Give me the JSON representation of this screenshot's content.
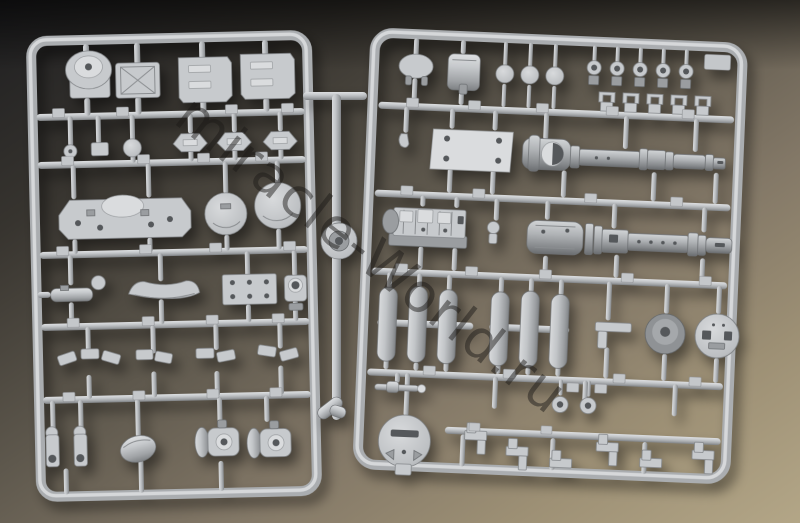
{
  "scene": {
    "type": "photograph",
    "description": "Two light-gray injection-molded plastic model-kit sprues (runner frames full of tank model parts) lying on a dark desk, lit warmly from the lower right",
    "subject": "scale model kit sprues"
  },
  "watermark": {
    "text": "miracle-World.ru"
  },
  "colors": {
    "background_dark": "#202022",
    "background_tan": "#b2a485",
    "plastic": "#c7cacd",
    "plastic_shadow": "#84878a",
    "plastic_dark": "#9a9da0",
    "hole": "#55585b"
  },
  "sprues": {
    "left": {
      "name": "left sprue frame",
      "parts": [
        "commander cupola",
        "hatch with X brace",
        "stowage box",
        "stowage box",
        "small cap",
        "small block",
        "ball mount",
        "hex hatch",
        "hex hatch",
        "hex hatch",
        "hull deck piece",
        "wheel disc",
        "wheel disc",
        "exhaust muffler",
        "curved fender",
        "bolted plate",
        "cylinder mount",
        "mounting brackets (4 sets)",
        "towing shackle",
        "towing shackle",
        "oval drum",
        "final drive housing",
        "final drive housing"
      ]
    },
    "center": {
      "name": "loose center runner",
      "parts": [
        "runner rod",
        "round wheel blank",
        "angled elbow joint"
      ]
    },
    "right": {
      "name": "right sprue frame",
      "parts": [
        "vision port",
        "cylinder drum",
        "wheel cap",
        "wheel cap",
        "wheel cap",
        "towing eye (x5)",
        "U-clamp (x5)",
        "engine deck plate",
        "tow hook",
        "gun barrel half with muzzle brake",
        "engine block",
        "gun barrel half",
        "tire half (x6)",
        "T bracket",
        "idler hub",
        "slotted hub cap",
        "machine-gun barrel",
        "eyelet",
        "eyelet",
        "round access cover",
        "periscope bracket (x6)"
      ]
    }
  }
}
